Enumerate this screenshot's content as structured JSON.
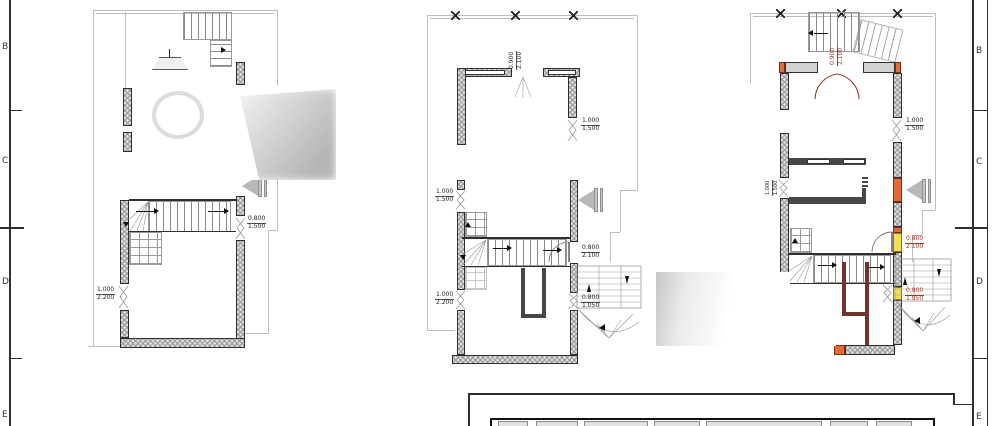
{
  "sheet": {
    "grid_labels_left": [
      "B",
      "C",
      "D",
      "E"
    ],
    "grid_labels_right": [
      "B",
      "C",
      "D",
      "E"
    ]
  },
  "colors": {
    "wall_hatch_fill": "#dcdcdc",
    "line_dark": "#2f2f2f",
    "line_light": "#bdbdbd",
    "accent_red": "#a03626",
    "highlight_orange": "#e36b36",
    "highlight_yellow": "#f1df55",
    "partition_brown": "#6e352a",
    "arrow_gray": "#b8b8b8"
  },
  "plans": {
    "left": {
      "doors": {
        "right": {
          "w": "0.800",
          "h": "1.500"
        },
        "left": {
          "w": "1.000",
          "h": "2.200"
        }
      }
    },
    "middle": {
      "doors": {
        "top": {
          "w": "0.900",
          "h": "2.100"
        },
        "left_upper": {
          "w": "1.000",
          "h": "1.500"
        },
        "left_lower": {
          "w": "1.000",
          "h": "2.200"
        },
        "right_upper": {
          "w": "1.000",
          "h": "1.500"
        },
        "right_mid": {
          "w": "0.800",
          "h": "2.100"
        },
        "right_lower": {
          "w": "0.800",
          "h": "1.050"
        }
      }
    },
    "right": {
      "doors": {
        "top": {
          "w": "0.900",
          "h": "2.100"
        },
        "left_mid": {
          "w": "1.000",
          "h": "1.500"
        },
        "right_upper": {
          "w": "1.000",
          "h": "1.500"
        },
        "right_mid": {
          "w": "0.800",
          "h": "2.100"
        },
        "right_lower": {
          "w": "0.800",
          "h": "1.050"
        }
      }
    }
  }
}
